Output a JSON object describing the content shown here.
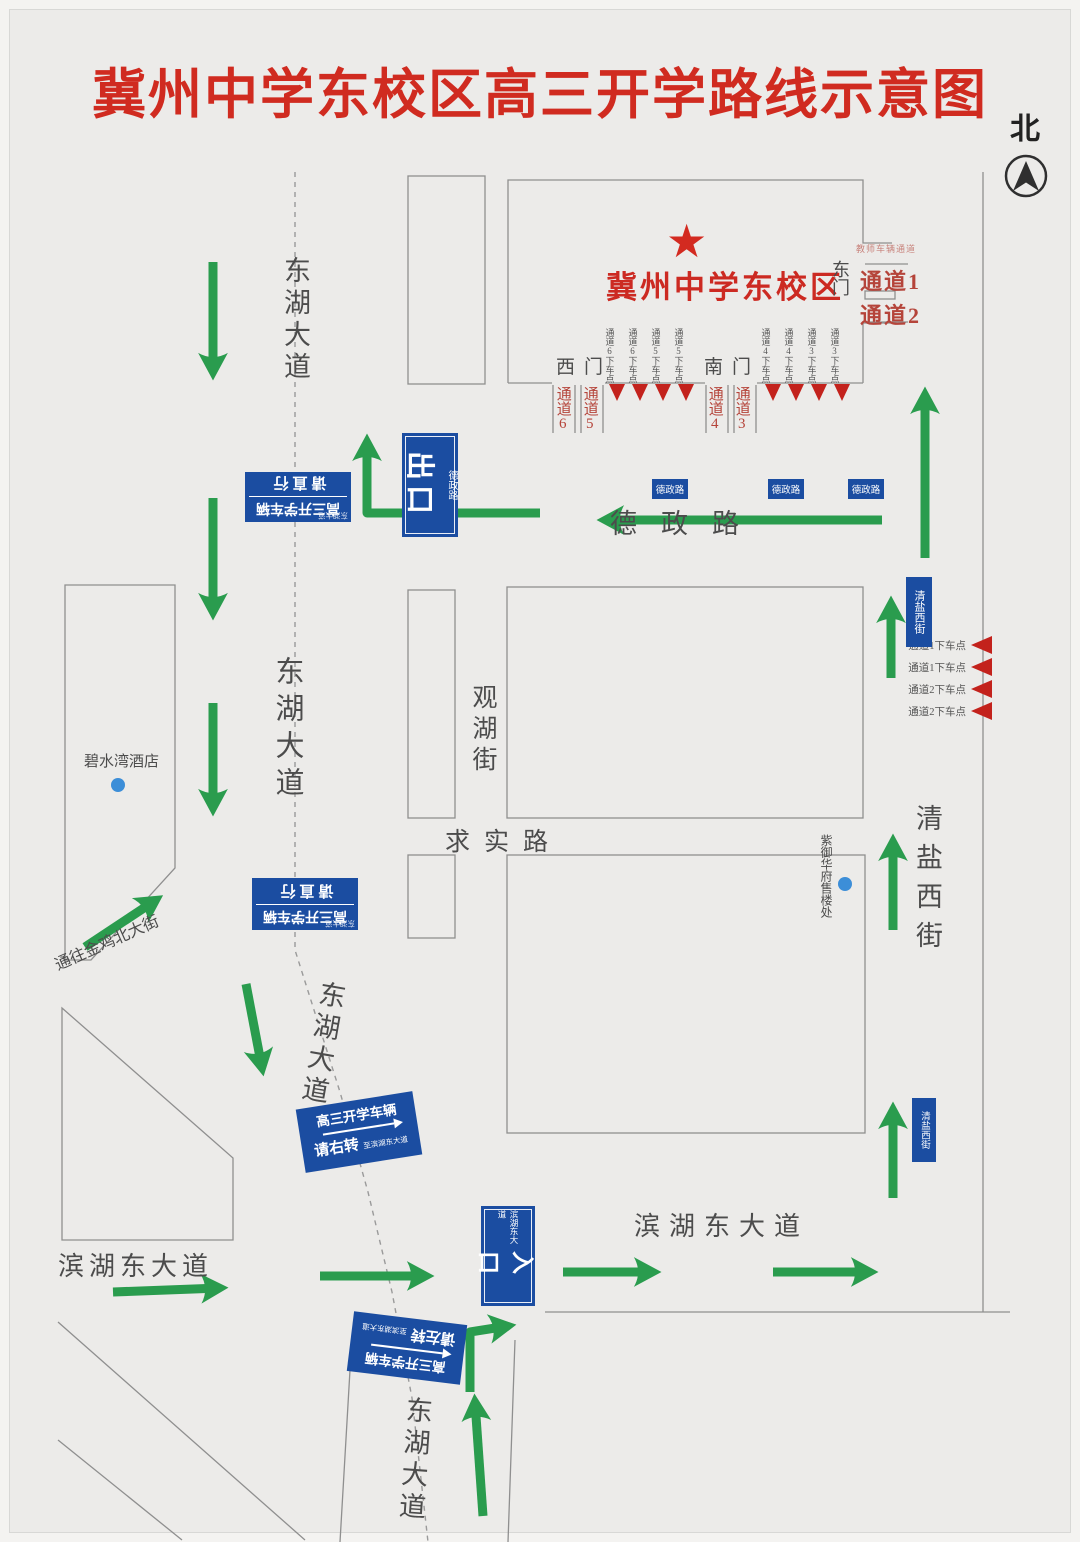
{
  "title": "冀州中学东校区高三开学路线示意图",
  "compass": {
    "north_label": "北"
  },
  "campus": {
    "star": "★",
    "name": "冀州中学东校区",
    "east_gate": "东门",
    "west_gate": "西门",
    "south_gate": "南门",
    "east_channel_note": "教师车辆通道",
    "channel_1": "通道1",
    "channel_2": "通道2",
    "channel_3": "通道3",
    "channel_4": "通道4",
    "channel_5": "通道5",
    "channel_6": "通道6",
    "south_dropoffs": [
      "通道6下车点",
      "通道6下车点",
      "通道5下车点",
      "通道5下车点",
      "通道4下车点",
      "通道4下车点",
      "通道3下车点",
      "通道3下车点"
    ],
    "east_dropoffs": [
      "通道1下车点",
      "通道1下车点",
      "通道2下车点",
      "通道2下车点"
    ]
  },
  "roads": {
    "donghu": "东湖大道",
    "dezheng": "德政路",
    "guanhu": "观湖街",
    "qiushi": "求实路",
    "qingyan": "清盐西街",
    "binhu": "滨湖东大道",
    "jinji": "通往金鸡北大街"
  },
  "signs": {
    "exit_big": "出口",
    "exit_small": "德政路",
    "entrance_big": "入口",
    "entrance_small": "滨湖东大道",
    "straight_line1": "高三开学车辆",
    "straight_line2": "请直行",
    "straight_corner": "东湖大道",
    "right_line1": "高三开学车辆",
    "right_line2": "请右转",
    "right_small": "至滨湖东大道",
    "left_line1": "高三开学车辆",
    "left_line2": "请左转",
    "left_small": "至滨湖东大道",
    "dezheng_plate": "德政路",
    "qingyan_plate": "清盐西街"
  },
  "pois": {
    "hotel": "碧水湾酒店",
    "sales_office": "紫御华府售楼处"
  },
  "colors": {
    "title_red": "#d02b20",
    "channel_red": "#b5443a",
    "sign_blue": "#1b4da1",
    "arrow_green": "#2a9c4e",
    "poi_dot_blue": "#3c8ed8"
  }
}
